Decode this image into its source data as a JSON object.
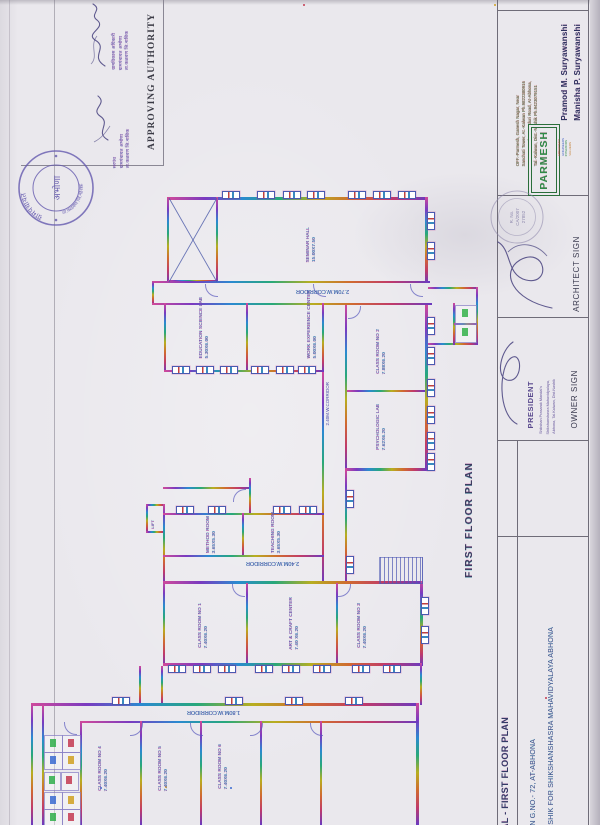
{
  "approving_authority": {
    "label": "APPROVING AUTHORITY",
    "officer_stamp_lines": [
      "ग्रामविकास अधिकारी",
      "ग्रामपंचायत अभोणा",
      "ता.कळवण जि.नाशिक"
    ],
    "sarpanch_stamp_lines": [
      "सरपंच",
      "ग्रामपंचायत अभोणा",
      "ता.कळवण जि.नाशिक"
    ],
    "round_stamp": {
      "arc_top": "ग्रामपंचायत",
      "center": "अभोणा",
      "arc_bottom": "ता.कळवण जि.नाशिक"
    }
  },
  "title_block": {
    "architect_firm": {
      "logo_text": "PARMESH",
      "logo_services": [
        "ARCHITECT",
        "ENGINEERS",
        "INTERIORS",
        "VALUERS"
      ],
      "architect_names": [
        "Pramod M. Suryawanshi",
        "Manisha P. Suryawanshi"
      ],
      "office_address_lines": [
        "OFF.-Parmesh, Ganesh Nagar, Near",
        "Sanchati Tower, At.-Kalwan  Ph.9822380916"
      ],
      "resi_address_lines": [
        "RESI.-Mangalya, Kanduri Road, At-Abhona,",
        "Tal.-Kalwan, Dist.-Nashik  Ph.9423079151"
      ],
      "stamp_lines": [
        "R. No.",
        "CA/2007",
        "27852"
      ]
    },
    "architect_sign_label": "ARCHITECT SIGN",
    "owner_sign_label": "OWNER SIGN",
    "president_stamp": {
      "title": "PRESIDENT",
      "lines": [
        "Shikshan Prasarak Mandal's",
        "Shikshanshasra Mahavidyalaya,",
        "Abhona, Tal.Kalwan, Dist.Nashik"
      ]
    },
    "drawing_title": "TAL - FIRST FLOOR PLAN",
    "project_lines": [
      "V IN G.NO.- 72, AT-ABHONA",
      "NASHIK FOR SHIKSHANSHASRA MAHAVIDYALAYA ABHONA"
    ]
  },
  "plan": {
    "caption": "FIRST FLOOR PLAN",
    "rooms": [
      {
        "name": "SEMINAR HALL",
        "dim": "15.00X7.50"
      },
      {
        "name": "EDUCATION SCIENCE LAB",
        "dim": "5.30X6.00"
      },
      {
        "name": "WORK EXPERIENCE CENTER",
        "dim": "5.00X6.00"
      },
      {
        "name": "CLASS ROOM NO 2",
        "dim": "7.88X6.20"
      },
      {
        "name": "PSYCHOLOGIC LAB",
        "dim": "7.62X6.20"
      },
      {
        "name": "METHOD ROOM",
        "dim": "3.65X5.30"
      },
      {
        "name": "TEACHING ROOM",
        "dim": "3.65X5.30"
      },
      {
        "name": "CLASS ROOM NO 1",
        "dim": "7.40X6.20"
      },
      {
        "name": "ART & CRAFT CENTER",
        "dim": "7.40 X6.20"
      },
      {
        "name": "CLASS ROOM NO 3",
        "dim": "7.40X6.20"
      },
      {
        "name": "CLASS ROOM NO 4",
        "dim": "7.40X6.20"
      },
      {
        "name": "CLASS ROOM NO 5",
        "dim": "7.40X6.20"
      },
      {
        "name": "CLASS ROOM NO 6",
        "dim": "7.40X6.20"
      },
      {
        "name": "LIFT",
        "dim": ""
      }
    ],
    "corridors": [
      "2.70M.W.CORRIDOR",
      "2.40M.W.CORRIDOR",
      "2.40M.W.CORRIDOR",
      "1.80M.W.CORRIDOR"
    ]
  },
  "colors": {
    "paper": "#eae8ed",
    "stamp_purple": "#6459ae",
    "logo_green": "#2e8b47",
    "signature_ink": "#46417e",
    "plan_label": "#7a3aa8"
  }
}
